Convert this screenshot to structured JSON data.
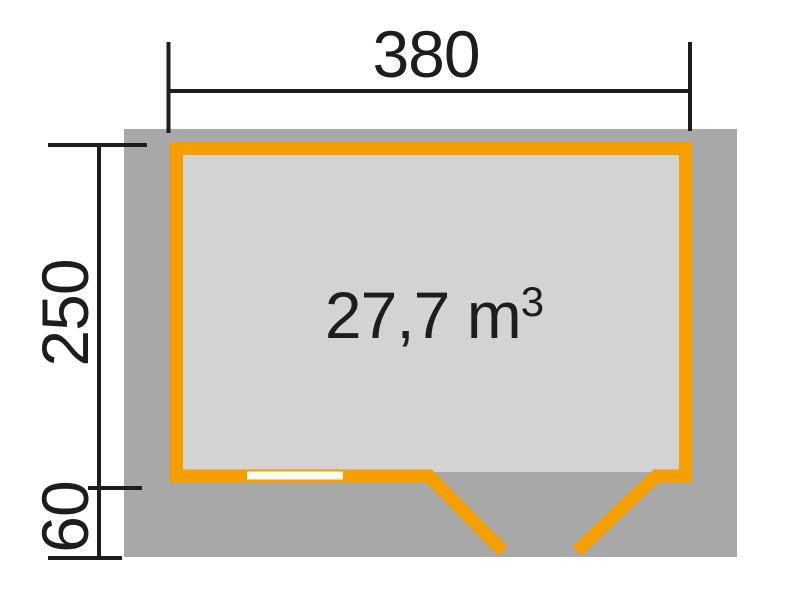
{
  "plan": {
    "labels": {
      "width": "380",
      "depth": "250",
      "overhang": "60",
      "volume_value": "27,7 m",
      "volume_exponent": "3"
    },
    "colors": {
      "background": "#FFFFFF",
      "overhang_area": "#A8A8A8",
      "floor": "#D3D3D3",
      "wall": "#F59E00",
      "window": "#FFFEF6",
      "dimension_lines": "#1D1D1B",
      "text": "#1D1D1B"
    }
  }
}
